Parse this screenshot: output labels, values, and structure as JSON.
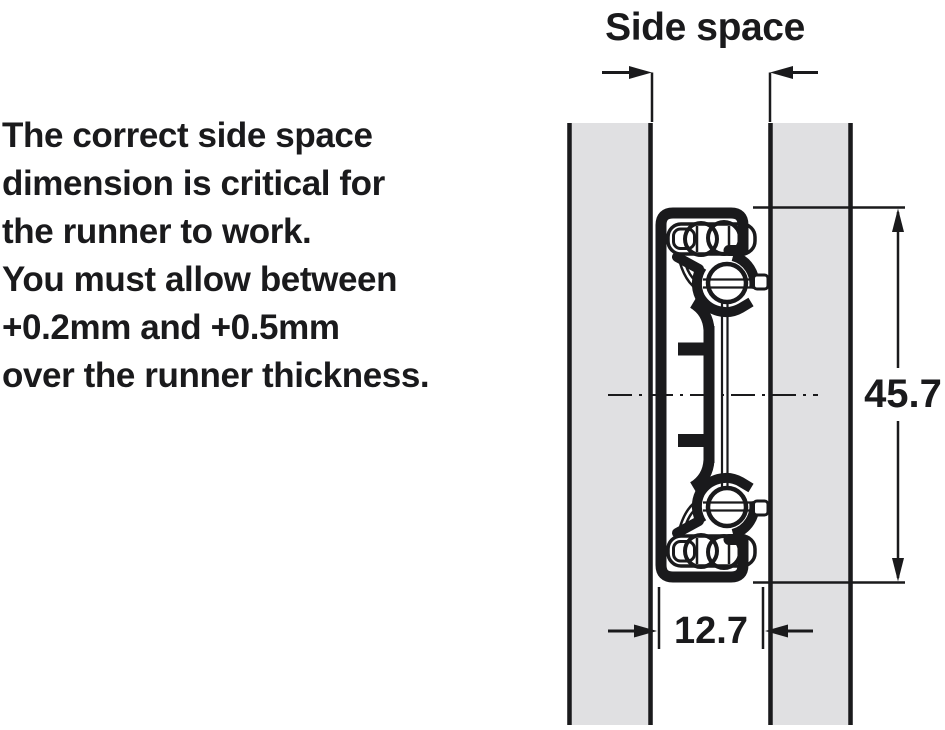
{
  "description": {
    "lines": [
      "The correct side space",
      "dimension is critical for",
      "the runner to work.",
      "You must allow between",
      "+0.2mm and +0.5mm",
      "over the runner thickness."
    ]
  },
  "diagram": {
    "title": "Side space",
    "dimensions": {
      "runner_height_mm": "45.7",
      "runner_thickness_mm": "12.7"
    },
    "colors": {
      "line_color": "#1a1a1c",
      "panel_fill": "#e0e0e2",
      "background": "#ffffff"
    }
  }
}
